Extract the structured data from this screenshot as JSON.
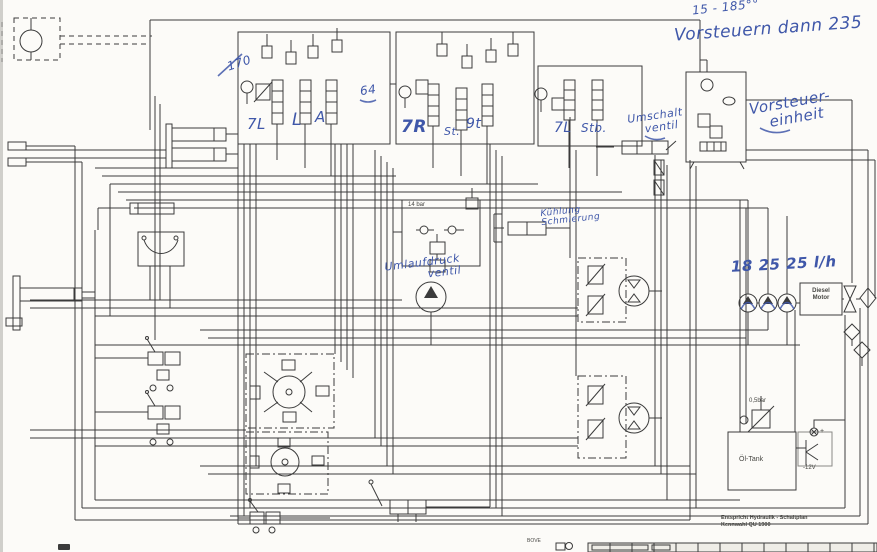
{
  "scan": {
    "paper": "#fcfbf8",
    "ink": "#3b3b3b",
    "blue_ink": "#3f57a9",
    "edge": "#b9b7b2"
  },
  "handwriting": {
    "flow_note": "15 - 185°°",
    "main_note": "Vorsteuern dann 235",
    "vorsteuer_line1": "Vorsteuer-",
    "vorsteuer_line2": "einheit",
    "pressure_170": "170",
    "note_64": "64",
    "bank1_label1": "7L",
    "bank1_label2": "L",
    "bank1_label3": "A",
    "bank2_label1": "7R",
    "bank2_label2": "St.",
    "bank2_label3": "9t",
    "bank3_label1": "7L",
    "bank3_label2": "Stb.",
    "umschalt_line1": "Umschalt",
    "umschalt_line2": "ventil",
    "kuehlung_line1": "Kühlung",
    "kuehlung_line2": "Schmierung",
    "umlauf_line1": "Umlaufdruck",
    "umlauf_line2": "ventil",
    "pump_flows": "18 25 25 l/h"
  },
  "printed": {
    "pressure_14bar": "14 bar",
    "diesel_line1": "Diesel",
    "diesel_line2": "Motor",
    "filter_05bar": "0,5bar",
    "oil_tank": "Öl-Tank",
    "minus_12v": "-12V",
    "plus": "+",
    "title_line1": "Entspricht Hydraulik - Schaltplan",
    "title_line2": "Kennwahl QU 1900",
    "footer_mark": "BOVE"
  }
}
